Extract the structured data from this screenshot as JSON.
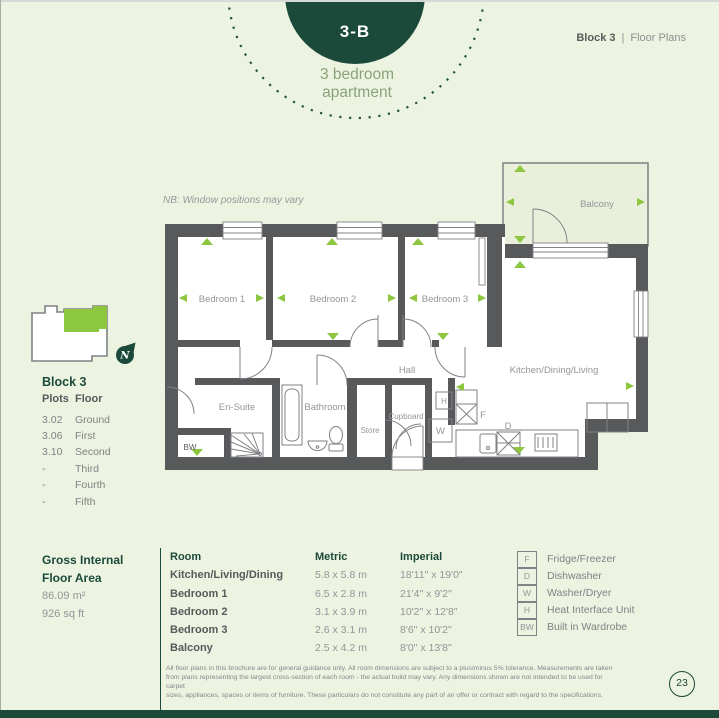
{
  "colors": {
    "background": "#edf3e1",
    "dark_green": "#1c4a3a",
    "lime_green": "#8dc63f",
    "wall_gray": "#58595b",
    "label_gray": "#939598",
    "balcony_fill": "#e9efda"
  },
  "header": {
    "unit_code": "3-B",
    "unit_type_line1": "3 bedroom",
    "unit_type_line2": "apartment",
    "breadcrumb_block": "Block 3",
    "breadcrumb_divider": "|",
    "breadcrumb_section": "Floor Plans"
  },
  "floor_plan": {
    "note": "NB: Window positions may vary",
    "labels": {
      "bedroom1": "Bedroom 1",
      "bedroom2": "Bedroom 2",
      "bedroom3": "Bedroom 3",
      "hall": "Hall",
      "kitchen": "Kitchen/Dining/Living",
      "ensuite": "En-Suite",
      "bathroom": "Bathroom",
      "store": "Store",
      "cupboard": "Cupboard",
      "balcony": "Balcony",
      "bw": "BW",
      "h": "H",
      "w": "W",
      "f": "F",
      "d": "D"
    }
  },
  "site_block": {
    "title": "Block 3",
    "col_plots": "Plots",
    "col_floor": "Floor",
    "rows": [
      {
        "plot": "3.02",
        "floor": "Ground"
      },
      {
        "plot": "3.06",
        "floor": "First"
      },
      {
        "plot": "3.10",
        "floor": "Second"
      },
      {
        "plot": "-",
        "floor": "Third"
      },
      {
        "plot": "-",
        "floor": "Fourth"
      },
      {
        "plot": "-",
        "floor": "Fifth"
      }
    ],
    "compass": "N"
  },
  "area_block": {
    "title_line1": "Gross Internal",
    "title_line2": "Floor Area",
    "metric": "86.09 m²",
    "imperial": "926 sq ft"
  },
  "rooms_table": {
    "headers": {
      "room": "Room",
      "metric": "Metric",
      "imperial": "Imperial"
    },
    "rows": [
      {
        "room": "Kitchen/Living/Dining",
        "metric": "5.8 x 5.8 m",
        "imperial": "18'11\" x 19'0\""
      },
      {
        "room": "Bedroom 1",
        "metric": "6.5 x 2.8 m",
        "imperial": "21'4\" x 9'2\""
      },
      {
        "room": "Bedroom 2",
        "metric": "3.1 x 3.9 m",
        "imperial": "10'2\" x 12'8\""
      },
      {
        "room": "Bedroom 3",
        "metric": "2.6 x 3.1 m",
        "imperial": "8'6\" x 10'2\""
      },
      {
        "room": "Balcony",
        "metric": "2.5 x 4.2 m",
        "imperial": "8'0\" x 13'8\""
      }
    ]
  },
  "legend": {
    "items": [
      {
        "key": "F",
        "label": "Fridge/Freezer"
      },
      {
        "key": "D",
        "label": "Dishwasher"
      },
      {
        "key": "W",
        "label": "Washer/Dryer"
      },
      {
        "key": "H",
        "label": "Heat Interface Unit"
      },
      {
        "key": "BW",
        "label": "Built in Wardrobe"
      }
    ]
  },
  "footer": {
    "disclaimer_line1": "All floor plans in this brochure are for general guidance only. All room dimensions are subject to a plus/minus 5% tolerance. Measurements are taken",
    "disclaimer_line2": "from plans representing the largest cross-section of each room - the actual build may vary. Any dimensions shown are not intended to be used for carpet",
    "disclaimer_line3": "sizes, appliances, spaces or items of furniture. These particulars do not constitute any part of an offer or contract with regard to the specifications.",
    "page_number": "23"
  }
}
